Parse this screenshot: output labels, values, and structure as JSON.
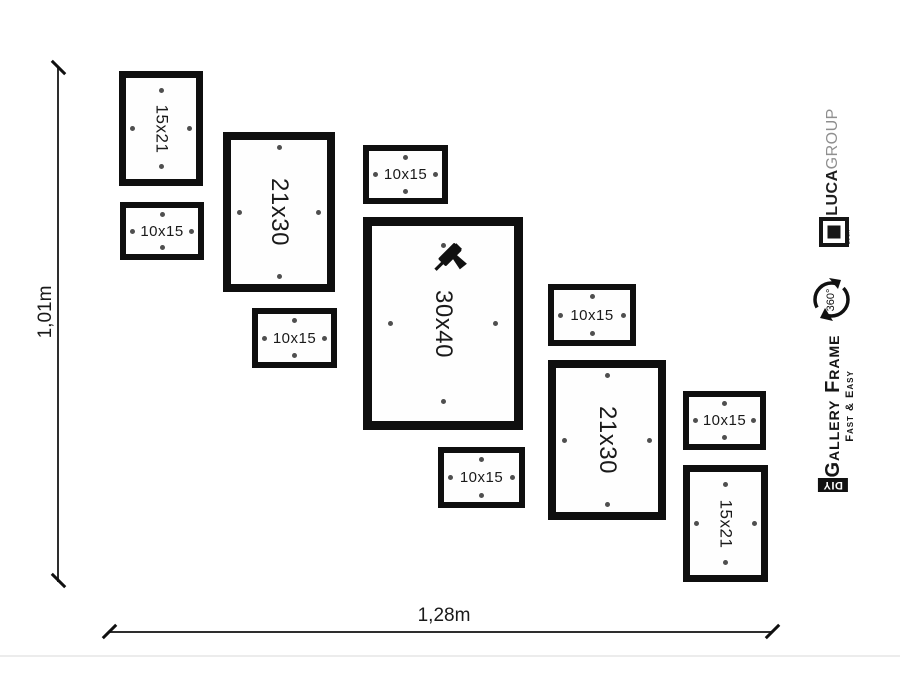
{
  "dimensions": {
    "height_label": "1,01m",
    "width_label": "1,28m"
  },
  "frames": [
    {
      "label": "15x21",
      "orientation": "vertical",
      "x": 119,
      "y": 71,
      "w": 84,
      "h": 115
    },
    {
      "label": "10x15",
      "orientation": "horizontal",
      "x": 120,
      "y": 202,
      "w": 84,
      "h": 58
    },
    {
      "label": "21x30",
      "orientation": "vertical",
      "x": 223,
      "y": 132,
      "w": 112,
      "h": 160
    },
    {
      "label": "10x15",
      "orientation": "horizontal",
      "x": 363,
      "y": 145,
      "w": 85,
      "h": 59
    },
    {
      "label": "30x40",
      "orientation": "vertical",
      "x": 363,
      "y": 217,
      "w": 160,
      "h": 213,
      "drill": true
    },
    {
      "label": "10x15",
      "orientation": "horizontal",
      "x": 252,
      "y": 308,
      "w": 85,
      "h": 60
    },
    {
      "label": "10x15",
      "orientation": "horizontal",
      "x": 438,
      "y": 447,
      "w": 87,
      "h": 61
    },
    {
      "label": "10x15",
      "orientation": "horizontal",
      "x": 548,
      "y": 284,
      "w": 88,
      "h": 62
    },
    {
      "label": "21x30",
      "orientation": "vertical",
      "x": 548,
      "y": 360,
      "w": 118,
      "h": 160
    },
    {
      "label": "10x15",
      "orientation": "horizontal",
      "x": 683,
      "y": 391,
      "w": 83,
      "h": 59
    },
    {
      "label": "15x21",
      "orientation": "vertical",
      "x": 683,
      "y": 465,
      "w": 85,
      "h": 117
    }
  ],
  "branding": {
    "company_bold": "LUCA",
    "company_light": "GROUP",
    "logo_tiny_text": "LUCA",
    "rotation_label": "360°",
    "product_name": "Gallery Frame",
    "product_tagline": "Fast & Easy",
    "diy_label": "DIY"
  },
  "icons": {
    "drill": "power-drill-icon",
    "rotation": "rotation-360-icon",
    "logo": "luca-square-logo-icon",
    "mounting_dot": "mounting-dot",
    "dimension_tick": "dimension-tick"
  },
  "colors": {
    "background": "#ffffff",
    "frame_border": "#0f0f0f",
    "text": "#1a1a1a",
    "company_light_gray": "#8f8f8f",
    "dot": "#4f4f4f"
  }
}
